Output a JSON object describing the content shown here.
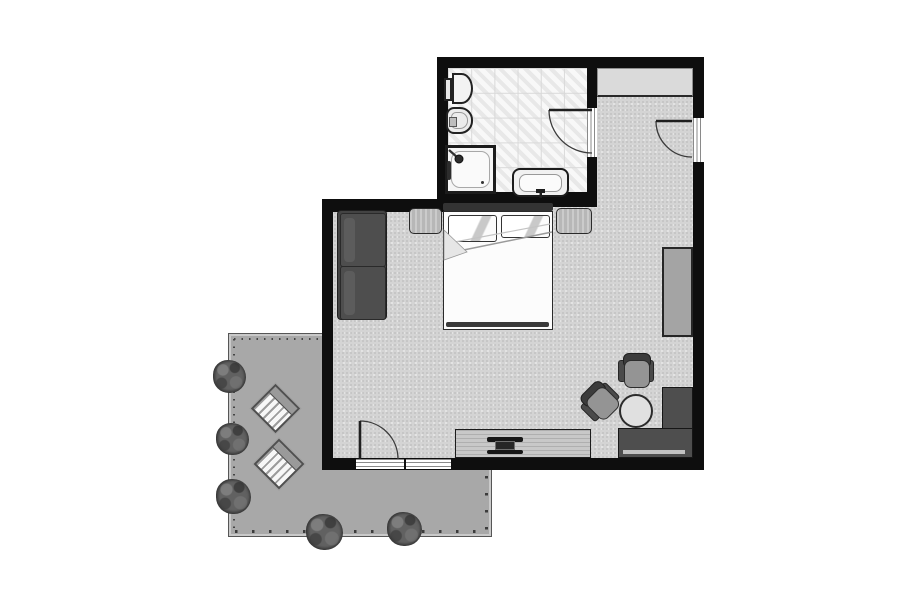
{
  "colors": {
    "page-bg": "#ffffff",
    "wall": "#0e0e0e",
    "outline": "#222222",
    "bath-floor": "#efefef",
    "tile-line": "#d9d9d9",
    "carpet": "#d4d4d4",
    "carpet-dot-dark": "#c2c2c2",
    "carpet-dot-light": "#e7e7e7",
    "terrace": "#a8a8a8",
    "terrace-border": "#565656",
    "terrace-inner-line": "#c9c9c9",
    "terrace-tick": "#454545",
    "closet": "#dadada",
    "wood-light": "#c8c8c8",
    "furniture-light": "#b7b7b7",
    "furniture-mid": "#a4a4a4",
    "sofa": "#434343",
    "sofa-cushion": "#4e4e4e",
    "sofa-highlight": "#5f5f5f",
    "desk": "#4e4e4e",
    "desk-shelf": "#c2c2c2",
    "chair-seat": "#949494",
    "chair-back": "#3c3c3c",
    "bed-white": "#fcfcfc",
    "fixture-white": "#f2f2f2",
    "fold-line": "#9a9a9a",
    "tv-dark": "#161616",
    "bush-base": "#565656",
    "sunbed-stripe": "#9c9c9c",
    "sunbed-white": "#f7f7f7",
    "headboard": "#333333"
  },
  "plan": {
    "type": "hotel-room-floor-plan",
    "rooms": [
      {
        "name": "bathroom",
        "symbols": [
          "toilet",
          "bidet",
          "shower",
          "sink",
          "swing-door"
        ]
      },
      {
        "name": "entry-hall",
        "symbols": [
          "closet",
          "entry-swing-door"
        ]
      },
      {
        "name": "bedroom",
        "symbols": [
          "double-bed",
          "pillow",
          "pillow",
          "nightstand",
          "nightstand",
          "sofa",
          "wardrobe",
          "l-shaped-desk",
          "desk-chair",
          "desk-chair",
          "round-table",
          "tv-console",
          "tv",
          "terrace-swing-door",
          "window"
        ]
      },
      {
        "name": "terrace",
        "symbols": [
          "sun-lounger",
          "sun-lounger",
          "shrub",
          "shrub",
          "shrub",
          "shrub",
          "shrub"
        ]
      }
    ]
  }
}
